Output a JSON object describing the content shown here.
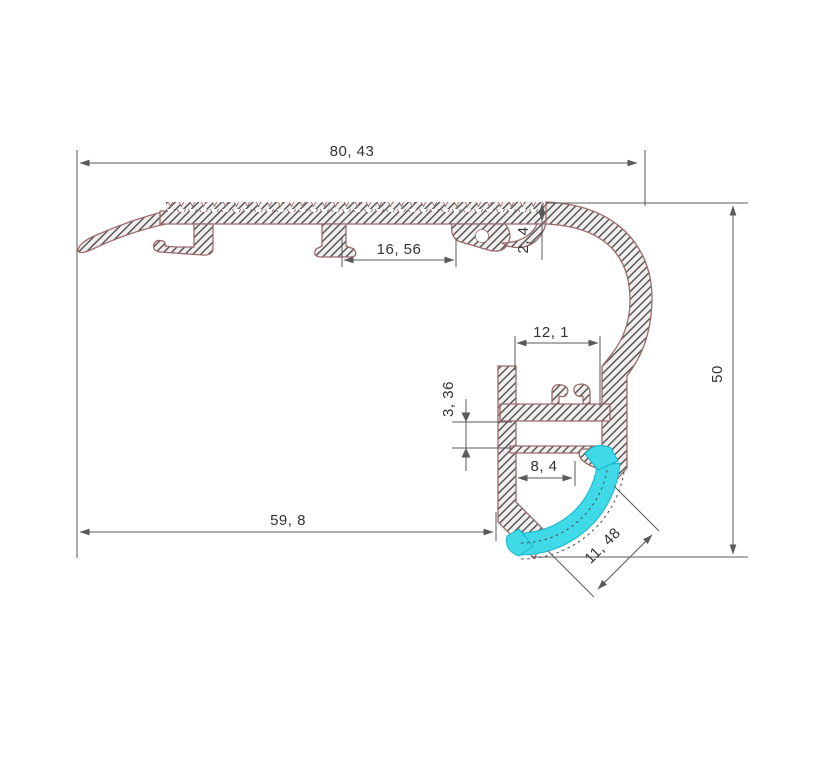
{
  "drawing": {
    "dimensions": {
      "overall_width": "80, 43",
      "top_slot_width": "16, 56",
      "tread_thickness": "2, 4",
      "channel_width": "12, 1",
      "pcb_slot_height": "3, 36",
      "lens_inset": "8, 4",
      "left_section_width": "59, 8",
      "overall_height": "50",
      "lens_arc_width": "11, 48"
    },
    "colors": {
      "bg": "#ffffff",
      "outline": "#9c6b6b",
      "hatch": "#4f4f4f",
      "fill": "#f1efed",
      "dim": "#5a5a5a",
      "text": "#333333",
      "cyan": "#3fd9e8",
      "cyan_dark": "#17b7cb",
      "hidden": "#4a4a4a"
    }
  }
}
